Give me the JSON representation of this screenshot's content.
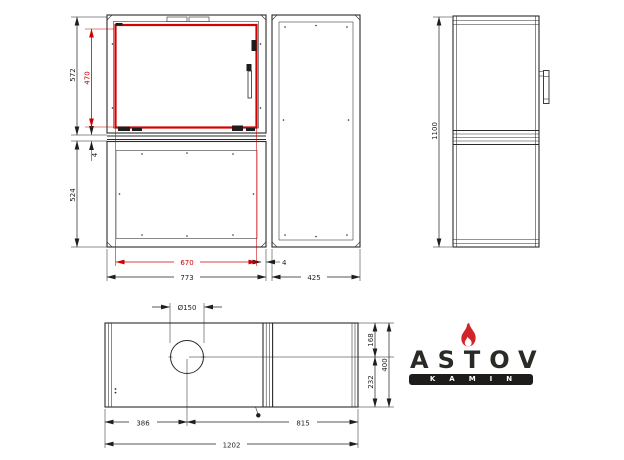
{
  "drawing": {
    "type": "fireplace-insert-technical-drawing",
    "colors": {
      "line": "#2a2a2a",
      "dimension": "#1f1f1f",
      "highlight_red": "#cc0000",
      "logo_text": "#2c2a27",
      "logo_flame": "#d2232a",
      "logo_bar": "#1d1c1a"
    }
  },
  "dims": {
    "front_overall_height": "572",
    "glass_height": "470",
    "gap_vertical": "4",
    "base_height": "524",
    "glass_width": "670",
    "front_width": "773",
    "gap_horizontal": "4",
    "side_depth": "425",
    "overall_height": "1100",
    "flue_diameter": "Ø150",
    "flue_from_left": "386",
    "flue_to_right": "815",
    "overall_width": "1202",
    "flue_from_front": "168",
    "flue_to_back": "232",
    "overall_depth": "400"
  },
  "logo": {
    "brand": "ASTOV",
    "subtitle": "KAMIN"
  }
}
